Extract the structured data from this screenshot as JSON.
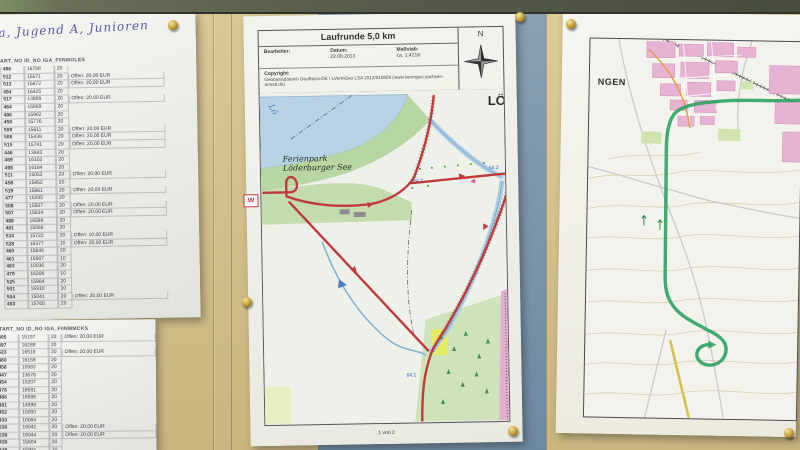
{
  "handwritten_note": {
    "text": "ga, Jugend A, Junioren"
  },
  "left_paper_top": {
    "header": "ART_NO  ID_NO  IGA_F0NMOLES",
    "rows": [
      [
        "496",
        "16788",
        "20",
        ""
      ],
      [
        "512",
        "15671",
        "20",
        "Offen: 20,00 EUR"
      ],
      [
        "513",
        "15872",
        "20",
        "Offen: 20,00 EUR"
      ],
      [
        "494",
        "16425",
        "20",
        ""
      ],
      [
        "517",
        "13908",
        "20",
        "Offen: 20,00 EUR"
      ],
      [
        "464",
        "15969",
        "20",
        ""
      ],
      [
        "486",
        "15962",
        "20",
        ""
      ],
      [
        "458",
        "15776",
        "20",
        ""
      ],
      [
        "509",
        "15611",
        "20",
        "Offen: 20,00 EUR"
      ],
      [
        "506",
        "15438",
        "20",
        "Offen: 20,00 EUR"
      ],
      [
        "515",
        "15741",
        "20",
        "Offen: 20,00 EUR"
      ],
      [
        "446",
        "13843",
        "20",
        ""
      ],
      [
        "469",
        "16102",
        "20",
        ""
      ],
      [
        "498",
        "16184",
        "20",
        ""
      ],
      [
        "511",
        "15052",
        "20",
        "Offen: 20,00 EUR"
      ],
      [
        "458",
        "15852",
        "20",
        ""
      ],
      [
        "519",
        "15861",
        "20",
        "Offen: 20,00 EUR"
      ],
      [
        "477",
        "16295",
        "20",
        ""
      ],
      [
        "508",
        "15507",
        "20",
        "Offen: 20,00 EUR"
      ],
      [
        "507",
        "15634",
        "20",
        "Offen: 20,00 EUR"
      ],
      [
        "488",
        "16598",
        "20",
        ""
      ],
      [
        "481",
        "15056",
        "20",
        ""
      ],
      [
        "534",
        "15722",
        "20",
        "Offen: 10,00 EUR"
      ],
      [
        "528",
        "16377",
        "10",
        "Offen: 20,00 EUR"
      ],
      [
        "460",
        "15846",
        "20",
        ""
      ],
      [
        "461",
        "15907",
        "10",
        ""
      ],
      [
        "483",
        "10036",
        "20",
        ""
      ],
      [
        "479",
        "16208",
        "10",
        ""
      ],
      [
        "525",
        "15964",
        "20",
        ""
      ],
      [
        "501",
        "16910",
        "10",
        ""
      ],
      [
        "504",
        "15041",
        "20",
        "Offen: 20,00 EUR"
      ],
      [
        "463",
        "15765",
        "20",
        ""
      ]
    ]
  },
  "left_paper_bottom": {
    "header": "START_NO  ID_NO  IGA_F0NMMCKS",
    "rows": [
      [
        "405",
        "15197",
        "20",
        "Offen: 20,00 EUR"
      ],
      [
        "497",
        "16289",
        "20",
        ""
      ],
      [
        "523",
        "16518",
        "20",
        "Offen: 20,00 EUR"
      ],
      [
        "480",
        "16158",
        "20",
        ""
      ],
      [
        "458",
        "15583",
        "20",
        ""
      ],
      [
        "447",
        "13678",
        "20",
        ""
      ],
      [
        "454",
        "15207",
        "20",
        ""
      ],
      [
        "478",
        "16581",
        "20",
        ""
      ],
      [
        "486",
        "16588",
        "20",
        ""
      ],
      [
        "481",
        "14998",
        "20",
        ""
      ],
      [
        "452",
        "15000",
        "20",
        ""
      ],
      [
        "430",
        "10094",
        "20",
        ""
      ],
      [
        "538",
        "16042",
        "20",
        "Offen: 20,00 EUR"
      ],
      [
        "539",
        "16044",
        "20",
        "Offen: 20,00 EUR"
      ],
      [
        "439",
        "15604",
        "20",
        ""
      ],
      [
        "449",
        "15931",
        "20",
        ""
      ]
    ]
  },
  "route_map": {
    "title": "Laufrunde 5,0 km",
    "bearbeiter_label": "Bearbeiter:",
    "datum_label": "Datum:",
    "datum_value": "22.08.2013",
    "massstab_label": "Maßstab:",
    "massstab_value": "ca. 1:4216",
    "copyright_label": "Copyright:",
    "copyright_text": "Geobasisdaten© GeoBasis-DE / LVermGeo LSA 2012/010809 (www.lvermgeo.sachsen-anhalt.de)",
    "compass": "N",
    "page_footer": "1 von 2",
    "labels": {
      "ferienpark_line1": "Ferienpark",
      "ferienpark_line2": "Löderburger See",
      "lake_fragment": "Lö",
      "town_fragment": "LÖ",
      "elevation_1": "64,7",
      "elevation_2": "64,2",
      "elevation_3": "64,1",
      "start_marker": "W"
    },
    "colors": {
      "route": "#c03a3c",
      "lake": "#b9d3e6",
      "park": "#b7d6a2"
    }
  },
  "right_map": {
    "town_fragment": "NGEN",
    "route_color": "#27a05e"
  }
}
